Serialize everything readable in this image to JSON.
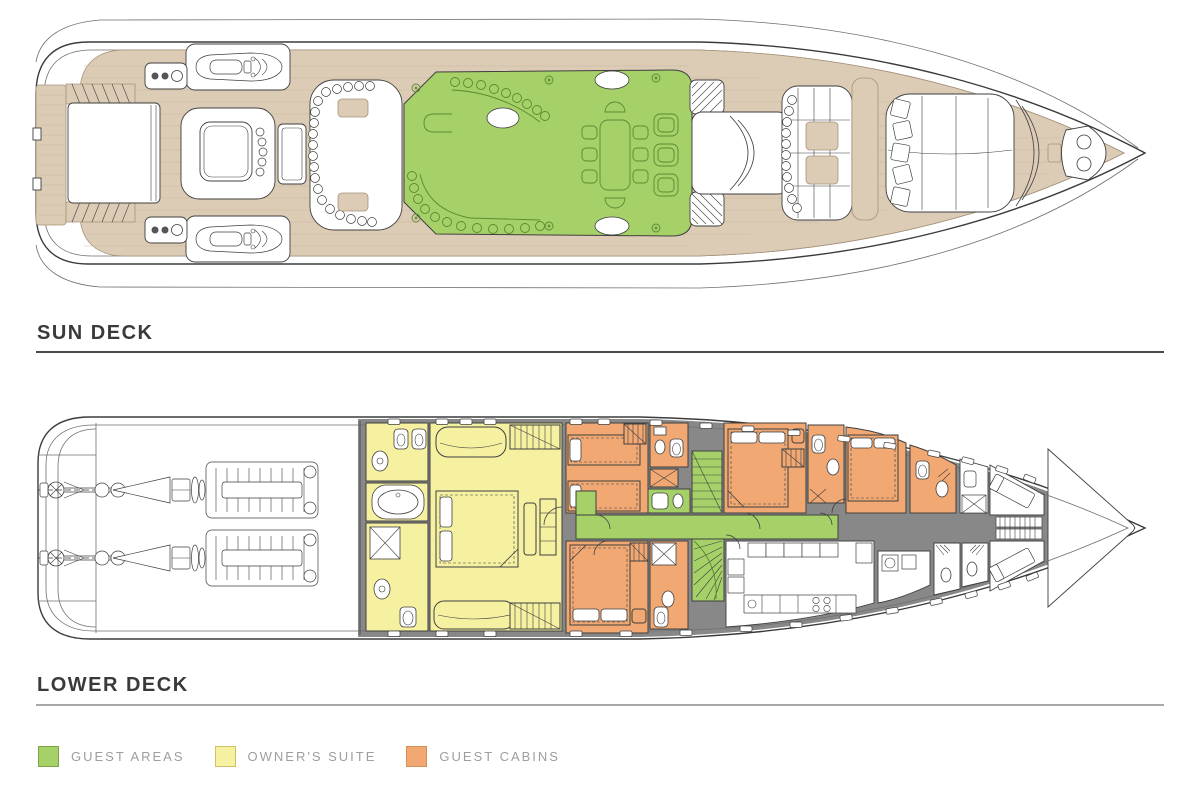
{
  "page": {
    "background": "#ffffff",
    "width": 1200,
    "height": 808
  },
  "decks": [
    {
      "id": "sun-deck",
      "title": "SUN DECK"
    },
    {
      "id": "lower-deck",
      "title": "LOWER DECK"
    }
  ],
  "legend": {
    "items": [
      {
        "label": "GUEST AREAS",
        "color": "#a6d169",
        "border": "#7ea544"
      },
      {
        "label": "OWNER'S SUITE",
        "color": "#f6f1a1",
        "border": "#cfc163"
      },
      {
        "label": "GUEST CABINS",
        "color": "#f1a873",
        "border": "#d68e52"
      }
    ]
  },
  "colors": {
    "teak": "#dccbb5",
    "teak-line": "#a6937a",
    "plank": "#cbbba2",
    "hull": "#3b3b3b",
    "innerline": "#6f6f6f",
    "guest": "#a6d169",
    "guest-line": "#5b8a2f",
    "owner": "#f6f1a1",
    "cabin": "#f1a873",
    "wall": "#888888",
    "line": "#3f3f3f",
    "rule1": "#4a4a4a",
    "rule2": "#a8a8a8",
    "heading": "#3a3a3a",
    "legendtext": "#9e9e9e"
  }
}
